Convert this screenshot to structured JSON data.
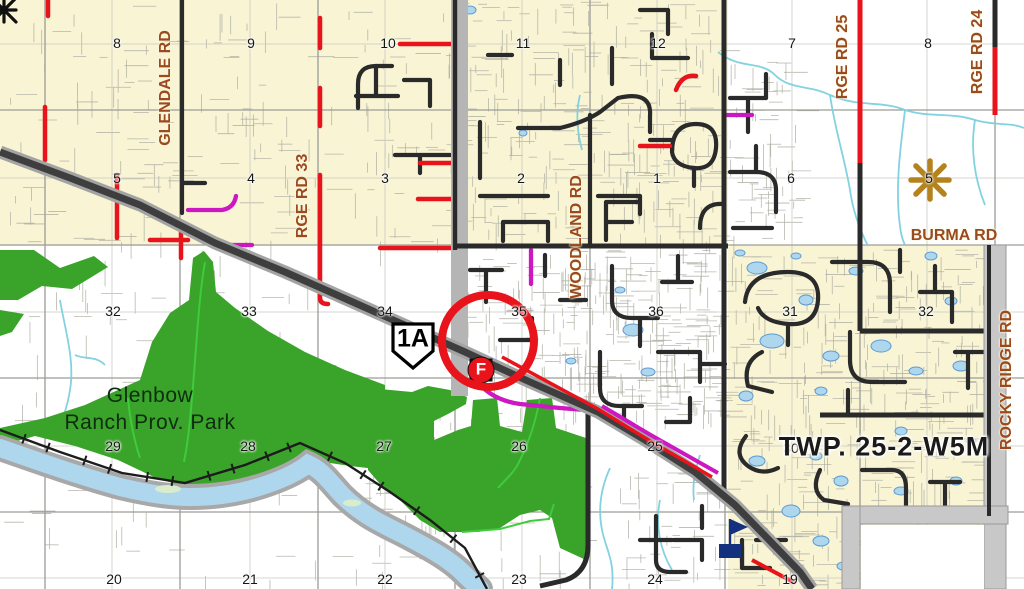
{
  "map": {
    "park_label": {
      "line1": "Glenbow",
      "line2": "Ranch Prov. Park",
      "x": 150,
      "y": 409
    },
    "township_label": {
      "text": "TWP. 25-2-W5M",
      "x": 884,
      "y": 447
    },
    "highway_shield": {
      "text": "1A"
    },
    "fire_marker": {
      "letter": "F"
    },
    "road_labels": [
      {
        "id": "glendale-rd",
        "text": "GLENDALE RD",
        "x": 166,
        "y": 88,
        "vertical": true
      },
      {
        "id": "rge-rd-33",
        "text": "RGE RD 33",
        "x": 303,
        "y": 196,
        "vertical": true
      },
      {
        "id": "woodland-rd",
        "text": "WOODLAND RD",
        "x": 577,
        "y": 237,
        "vertical": true
      },
      {
        "id": "rge-rd-25",
        "text": "RGE RD 25",
        "x": 843,
        "y": 57,
        "vertical": true
      },
      {
        "id": "rge-rd-24",
        "text": "RGE RD 24",
        "x": 978,
        "y": 52,
        "vertical": true
      },
      {
        "id": "rocky-ridge-rd",
        "text": "ROCKY RIDGE RD",
        "x": 1007,
        "y": 380,
        "vertical": true
      },
      {
        "id": "burma-rd",
        "text": "BURMA RD",
        "x": 954,
        "y": 236,
        "vertical": false
      }
    ],
    "section_numbers": [
      {
        "n": "8",
        "x": 117,
        "y": 43
      },
      {
        "n": "9",
        "x": 251,
        "y": 43
      },
      {
        "n": "10",
        "x": 388,
        "y": 43
      },
      {
        "n": "11",
        "x": 523,
        "y": 43
      },
      {
        "n": "12",
        "x": 658,
        "y": 43
      },
      {
        "n": "7",
        "x": 792,
        "y": 43
      },
      {
        "n": "8",
        "x": 928,
        "y": 43
      },
      {
        "n": "5",
        "x": 117,
        "y": 178
      },
      {
        "n": "4",
        "x": 251,
        "y": 178
      },
      {
        "n": "3",
        "x": 385,
        "y": 178
      },
      {
        "n": "2",
        "x": 521,
        "y": 178
      },
      {
        "n": "1",
        "x": 657,
        "y": 178
      },
      {
        "n": "6",
        "x": 791,
        "y": 178
      },
      {
        "n": "5",
        "x": 929,
        "y": 178
      },
      {
        "n": "32",
        "x": 113,
        "y": 311
      },
      {
        "n": "33",
        "x": 249,
        "y": 311
      },
      {
        "n": "34",
        "x": 385,
        "y": 311
      },
      {
        "n": "35",
        "x": 519,
        "y": 311
      },
      {
        "n": "36",
        "x": 656,
        "y": 311
      },
      {
        "n": "31",
        "x": 790,
        "y": 311
      },
      {
        "n": "32",
        "x": 926,
        "y": 311
      },
      {
        "n": "29",
        "x": 113,
        "y": 446
      },
      {
        "n": "28",
        "x": 248,
        "y": 446
      },
      {
        "n": "27",
        "x": 384,
        "y": 446
      },
      {
        "n": "26",
        "x": 519,
        "y": 446
      },
      {
        "n": "25",
        "x": 655,
        "y": 446
      },
      {
        "n": "30",
        "x": 791,
        "y": 448
      },
      {
        "n": "20",
        "x": 114,
        "y": 579
      },
      {
        "n": "21",
        "x": 250,
        "y": 579
      },
      {
        "n": "22",
        "x": 385,
        "y": 579
      },
      {
        "n": "23",
        "x": 519,
        "y": 579
      },
      {
        "n": "24",
        "x": 655,
        "y": 579
      },
      {
        "n": "19",
        "x": 790,
        "y": 579
      }
    ],
    "colors": {
      "developed_yellow": "#f8f4d4",
      "park_green": "#3aa32a",
      "stream_green": "#3ecb3c",
      "water_fill": "#aed7ee",
      "water_edge": "#5d9bd3",
      "creek_cyan": "#7cd0de",
      "road_black": "#2a2a2a",
      "road_red": "#e8131b",
      "road_magenta": "#cc17c3",
      "highway_dark": "#3e3e3e",
      "highway_casing": "#a3a3a3",
      "label_brown": "#9a4a1d",
      "marker_ring_red": "#e8131b",
      "flag_navy": "#14317d",
      "star_gold": "#b5831e"
    }
  }
}
